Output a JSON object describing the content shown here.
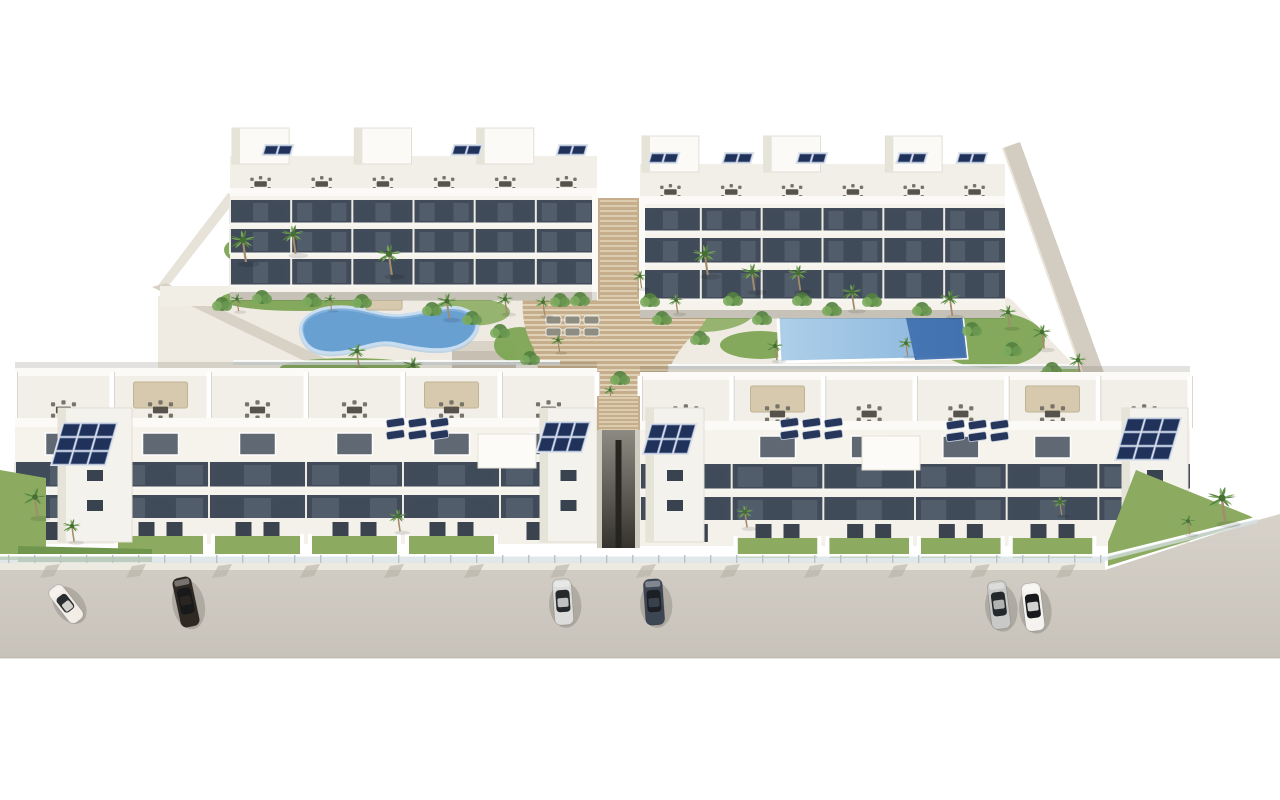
{
  "image": {
    "description": "Aerial 3D architectural rendering of a white Mediterranean apartment complex with rooftop solar panels and terraces, a landscaped courtyard with palm trees, a kidney-shaped pool, a rectangular pool, central terraced wooden stairs, and cars parked on the street in front",
    "width": 1280,
    "height": 800
  },
  "palette": {
    "bg": "#ffffff",
    "wall": "#f5f3ec",
    "wallBright": "#fbfaf6",
    "wallShade": "#e6e3d9",
    "terrace": "#f2efe8",
    "windowDark": "#414b59",
    "windowDarker": "#323a46",
    "windowLight": "#55606e",
    "mullion": "#ecebe3",
    "courtyard": "#efebe2",
    "road1": "#d7d2c9",
    "road2": "#c8c3ba",
    "sidewalk": "#edeae2",
    "curb": "#b5b1a6",
    "grass": "#8cab61",
    "grassDark": "#70954c",
    "foliage": "#53823f",
    "foliageLight": "#7cab5e",
    "trunk": "#a38b6b",
    "wood": "#c6ae8c",
    "woodSlat": "#e9ddc4",
    "poolMid": "#69a0d2",
    "poolInner": "#9ac1e4",
    "poolShallow": "#aecfe9",
    "poolDeep": "#3f6fae",
    "coping": "#ffffff",
    "solar": "#20315a",
    "solarLine": "#7e93bb",
    "solarBack": "#dfe3ea",
    "furniture": "#77746a",
    "furnitureDark": "#55534b",
    "pergola": "#d6c9ad",
    "glassFence": "#d6e0e4",
    "fenceRail": "#ffffff",
    "shadow": "rgba(80,75,60,0.16)",
    "alleyTop": "#8d8a82",
    "alleyBottom": "#35332d",
    "wallTan": "#d3ccc0"
  },
  "scene": {
    "canvas": {
      "w": 1280,
      "h": 800
    },
    "courtyard": {
      "pts": [
        [
          158,
          296
        ],
        [
          1005,
          296
        ],
        [
          1012,
          300
        ],
        [
          1100,
          392
        ],
        [
          1100,
          432
        ],
        [
          158,
          432
        ]
      ]
    },
    "leftWall": {
      "pts": [
        [
          152,
          287
        ],
        [
          166,
          283
        ],
        [
          398,
          393
        ],
        [
          383,
          399
        ]
      ]
    },
    "leftWallUpper": {
      "pts": [
        [
          228,
          193
        ],
        [
          238,
          197
        ],
        [
          170,
          284
        ],
        [
          156,
          288
        ]
      ]
    },
    "storage": {
      "x": 452,
      "y": 341,
      "w": 64,
      "h": 50
    },
    "diagWall": {
      "pts": [
        [
          1003,
          148
        ],
        [
          1020,
          142
        ],
        [
          1108,
          384
        ],
        [
          1089,
          392
        ]
      ]
    },
    "gardens": [
      {
        "cx": 300,
        "cy": 299,
        "rx": 80,
        "ry": 12
      },
      {
        "cx": 470,
        "cy": 312,
        "rx": 40,
        "ry": 14
      },
      {
        "cx": 520,
        "cy": 345,
        "rx": 26,
        "ry": 18
      },
      {
        "cx": 700,
        "cy": 310,
        "rx": 55,
        "ry": 22
      },
      {
        "cx": 760,
        "cy": 345,
        "rx": 40,
        "ry": 14
      },
      {
        "cx": 860,
        "cy": 300,
        "rx": 90,
        "ry": 10
      },
      {
        "cx": 990,
        "cy": 340,
        "rx": 55,
        "ry": 28
      },
      {
        "cx": 1070,
        "cy": 385,
        "rx": 40,
        "ry": 20
      },
      {
        "cx": 350,
        "cy": 368,
        "rx": 70,
        "ry": 10
      },
      {
        "cx": 620,
        "cy": 386,
        "rx": 40,
        "ry": 10
      },
      {
        "cx": 250,
        "cy": 250,
        "rx": 26,
        "ry": 14
      },
      {
        "cx": 395,
        "cy": 262,
        "rx": 24,
        "ry": 12
      },
      {
        "cx": 710,
        "cy": 265,
        "rx": 30,
        "ry": 14
      },
      {
        "cx": 800,
        "cy": 282,
        "rx": 34,
        "ry": 12
      }
    ],
    "stairs": {
      "path": "M536,258 C560,249 622,247 650,252 C690,257 707,269 699,283 C717,297 713,319 689,339 C676,353 668,369 661,388 L654,414 L566,414 C551,397 536,373 534,349 C519,322 518,291 536,258 Z",
      "y0": 250,
      "y1": 414,
      "step": 5
    },
    "rearPassageStairs": {
      "x": 598,
      "y": 198,
      "w": 41,
      "h": 100
    },
    "alley": {
      "x": 597,
      "w": 43,
      "top": 430,
      "bot": 548
    },
    "alleyStairs": {
      "x": 597,
      "y": 396,
      "w": 43,
      "h": 36
    },
    "poolLeft": {
      "path": "M301,331 C299,315 320,306 345,307 C368,308 381,317 403,315 C430,312 447,304 463,309 C479,314 482,327 470,339 C452,356 420,349 396,344 C373,339 356,353 332,353 C312,353 303,345 301,331 Z"
    },
    "poolRight": {
      "pts": [
        [
          778,
          316
        ],
        [
          962,
          313
        ],
        [
          967,
          358
        ],
        [
          780,
          362
        ]
      ],
      "deepPts": [
        [
          905,
          314
        ],
        [
          962,
          313
        ],
        [
          967,
          358
        ],
        [
          915,
          360
        ]
      ]
    },
    "rails": [
      {
        "x1": 233,
        "y1": 363,
        "x2": 560,
        "y2": 363
      },
      {
        "x1": 668,
        "y1": 367,
        "x2": 1096,
        "y2": 367
      }
    ],
    "canopies": [
      {
        "x": 366,
        "y": 286,
        "w": 36,
        "h": 24
      },
      {
        "x": 784,
        "y": 287,
        "w": 78,
        "h": 10
      },
      {
        "x": 898,
        "y": 288,
        "w": 74,
        "h": 10
      }
    ],
    "courtLoungers": [
      {
        "x": 546,
        "y": 316,
        "cols": 3,
        "rows": 2,
        "color": "#8f8c82"
      },
      {
        "x": 760,
        "y": 299,
        "cols": 5,
        "rows": 1,
        "color": "#b9b29f"
      }
    ],
    "rearLeft": {
      "x": 230,
      "w": 367,
      "units": 6,
      "roofY": 128,
      "pentH": 36,
      "terrH": 32,
      "facTop": 196,
      "facBot": 292,
      "bands": [
        [
          200,
          24
        ],
        [
          229,
          25
        ],
        [
          259,
          27
        ]
      ],
      "solarMinis": [
        266,
        455,
        560
      ],
      "pentUnits": [
        0,
        2,
        4
      ]
    },
    "rearRight": {
      "x": 640,
      "w": 365,
      "units": 6,
      "roofY": 136,
      "pentH": 36,
      "terrH": 32,
      "facTop": 204,
      "facBot": 310,
      "bands": [
        [
          208,
          24
        ],
        [
          238,
          26
        ],
        [
          270,
          30
        ]
      ],
      "solarMinis": [
        652,
        726,
        800,
        900,
        960
      ],
      "pentUnits": [
        0,
        2,
        4
      ]
    },
    "frontLeft": {
      "x": 15,
      "w": 582,
      "units": 6,
      "backY": 368,
      "terrH": 46,
      "parY": 418,
      "facTop": 427,
      "bands": [
        [
          462,
          26
        ],
        [
          495,
          26
        ]
      ],
      "groundY": 518,
      "groundH": 26,
      "gardenY": 536,
      "towers": [
        {
          "x": 58,
          "w": 74
        },
        {
          "x": 540,
          "w": 57
        }
      ],
      "solar": [
        {
          "x": 64,
          "y": 424,
          "c": 3,
          "r": 3,
          "cw": 16,
          "ch": 12
        },
        {
          "x": 546,
          "y": 423,
          "c": 3,
          "r": 2,
          "cw": 13,
          "ch": 13
        }
      ],
      "loungers": [
        {
          "x": 386,
          "y": 420
        }
      ],
      "pergolaUnits": [
        1,
        4
      ],
      "canopyBox": {
        "x": 478,
        "y": 434,
        "w": 58,
        "h": 34
      },
      "grassUnits": [
        1,
        2,
        3,
        4
      ]
    },
    "frontRight": {
      "x": 640,
      "w": 550,
      "units": 6,
      "backY": 372,
      "terrH": 46,
      "parY": 421,
      "facTop": 430,
      "bands": [
        [
          464,
          26
        ],
        [
          497,
          26
        ]
      ],
      "groundY": 520,
      "groundH": 26,
      "gardenY": 538,
      "towers": [
        {
          "x": 646,
          "w": 58
        },
        {
          "x": 1122,
          "w": 66
        }
      ],
      "solar": [
        {
          "x": 652,
          "y": 425,
          "c": 3,
          "r": 2,
          "cw": 13,
          "ch": 13
        },
        {
          "x": 1128,
          "y": 419,
          "c": 3,
          "r": 3,
          "cw": 16,
          "ch": 12
        }
      ],
      "loungers": [
        {
          "x": 780,
          "y": 420
        },
        {
          "x": 946,
          "y": 422
        }
      ],
      "pergolaUnits": [
        1,
        4
      ],
      "canopyBox": {
        "x": 862,
        "y": 436,
        "w": 58,
        "h": 34
      },
      "grassUnits": [
        1,
        2,
        3,
        4
      ]
    },
    "road": {
      "pts": [
        [
          0,
          570
        ],
        [
          1105,
          570
        ],
        [
          1258,
          520
        ],
        [
          1280,
          514
        ],
        [
          1280,
          658
        ],
        [
          0,
          658
        ]
      ]
    },
    "sidewalk": {
      "pts": [
        [
          0,
          562
        ],
        [
          1105,
          562
        ],
        [
          1105,
          570
        ],
        [
          0,
          570
        ]
      ]
    },
    "frontFence": {
      "x0": 0,
      "x1": 1105,
      "y": 554
    },
    "diagFence": {
      "x1": 1105,
      "y1": 556,
      "x2": 1258,
      "y2": 518
    },
    "curbMarks": {
      "xs": [
        46,
        132,
        218,
        306,
        390,
        470,
        556,
        642,
        726,
        810,
        894,
        976,
        1062
      ],
      "y": 566
    },
    "cornerGardenLeft": {
      "pts": [
        [
          0,
          470
        ],
        [
          46,
          478
        ],
        [
          46,
          560
        ],
        [
          0,
          560
        ]
      ],
      "strip": [
        [
          18,
          546
        ],
        [
          152,
          549
        ],
        [
          152,
          562
        ],
        [
          18,
          562
        ]
      ]
    },
    "cornerGardenRight": {
      "pts": [
        [
          1136,
          470
        ],
        [
          1250,
          516
        ],
        [
          1256,
          520
        ],
        [
          1108,
          566
        ],
        [
          1108,
          542
        ]
      ]
    },
    "cars": [
      {
        "cx": 66,
        "cy": 604,
        "angle": -38,
        "len": 42,
        "wid": 17,
        "body": "#f2ede7",
        "glass": "#2a2d30"
      },
      {
        "cx": 186,
        "cy": 602,
        "angle": -12,
        "len": 50,
        "wid": 19,
        "body": "#2f2823",
        "glass": "#17191b"
      },
      {
        "cx": 563,
        "cy": 602,
        "angle": -4,
        "len": 46,
        "wid": 19,
        "body": "#dcdcda",
        "glass": "#26292c"
      },
      {
        "cx": 654,
        "cy": 602,
        "angle": -4,
        "len": 46,
        "wid": 19,
        "body": "#3d4754",
        "glass": "#1c2024"
      },
      {
        "cx": 999,
        "cy": 605,
        "angle": -7,
        "len": 48,
        "wid": 19,
        "body": "#c9cac8",
        "glass": "#26292c"
      },
      {
        "cx": 1033,
        "cy": 607,
        "angle": -7,
        "len": 48,
        "wid": 19,
        "body": "#f4f3f0",
        "glass": "#17191c"
      }
    ],
    "palmsBack": [
      [
        243,
        240,
        1.0
      ],
      [
        293,
        234,
        0.9
      ],
      [
        389,
        254,
        0.95
      ],
      [
        447,
        301,
        0.8
      ],
      [
        505,
        299,
        0.65
      ],
      [
        543,
        302,
        0.6
      ],
      [
        357,
        351,
        0.75
      ],
      [
        413,
        365,
        0.8
      ],
      [
        470,
        384,
        0.6
      ],
      [
        558,
        340,
        0.55
      ],
      [
        640,
        276,
        0.55
      ],
      [
        676,
        300,
        0.6
      ],
      [
        705,
        254,
        0.95
      ],
      [
        752,
        272,
        0.85
      ],
      [
        798,
        273,
        0.8
      ],
      [
        852,
        292,
        0.8
      ],
      [
        906,
        343,
        0.6
      ],
      [
        775,
        346,
        0.65
      ],
      [
        950,
        298,
        0.8
      ],
      [
        1008,
        312,
        0.7
      ],
      [
        1042,
        332,
        0.75
      ],
      [
        1078,
        360,
        0.7
      ],
      [
        1100,
        412,
        0.6
      ],
      [
        237,
        299,
        0.55
      ],
      [
        330,
        299,
        0.5
      ],
      [
        610,
        390,
        0.5
      ],
      [
        980,
        388,
        0.55
      ]
    ],
    "palmsFront": [
      [
        35,
        497,
        0.9
      ],
      [
        72,
        526,
        0.7
      ],
      [
        398,
        516,
        0.7
      ],
      [
        745,
        512,
        0.7
      ],
      [
        1060,
        502,
        0.6
      ],
      [
        1222,
        498,
        1.1
      ],
      [
        1188,
        521,
        0.6
      ]
    ],
    "bushes": [
      [
        262,
        297
      ],
      [
        312,
        300
      ],
      [
        362,
        301
      ],
      [
        432,
        309
      ],
      [
        472,
        318
      ],
      [
        500,
        331
      ],
      [
        530,
        358
      ],
      [
        662,
        318
      ],
      [
        700,
        338
      ],
      [
        733,
        299
      ],
      [
        762,
        318
      ],
      [
        802,
        299
      ],
      [
        832,
        309
      ],
      [
        872,
        300
      ],
      [
        922,
        309
      ],
      [
        972,
        329
      ],
      [
        1012,
        349
      ],
      [
        1052,
        369
      ],
      [
        620,
        378
      ],
      [
        580,
        299
      ],
      [
        222,
        304
      ],
      [
        1088,
        388
      ],
      [
        650,
        300
      ],
      [
        560,
        300
      ]
    ]
  }
}
